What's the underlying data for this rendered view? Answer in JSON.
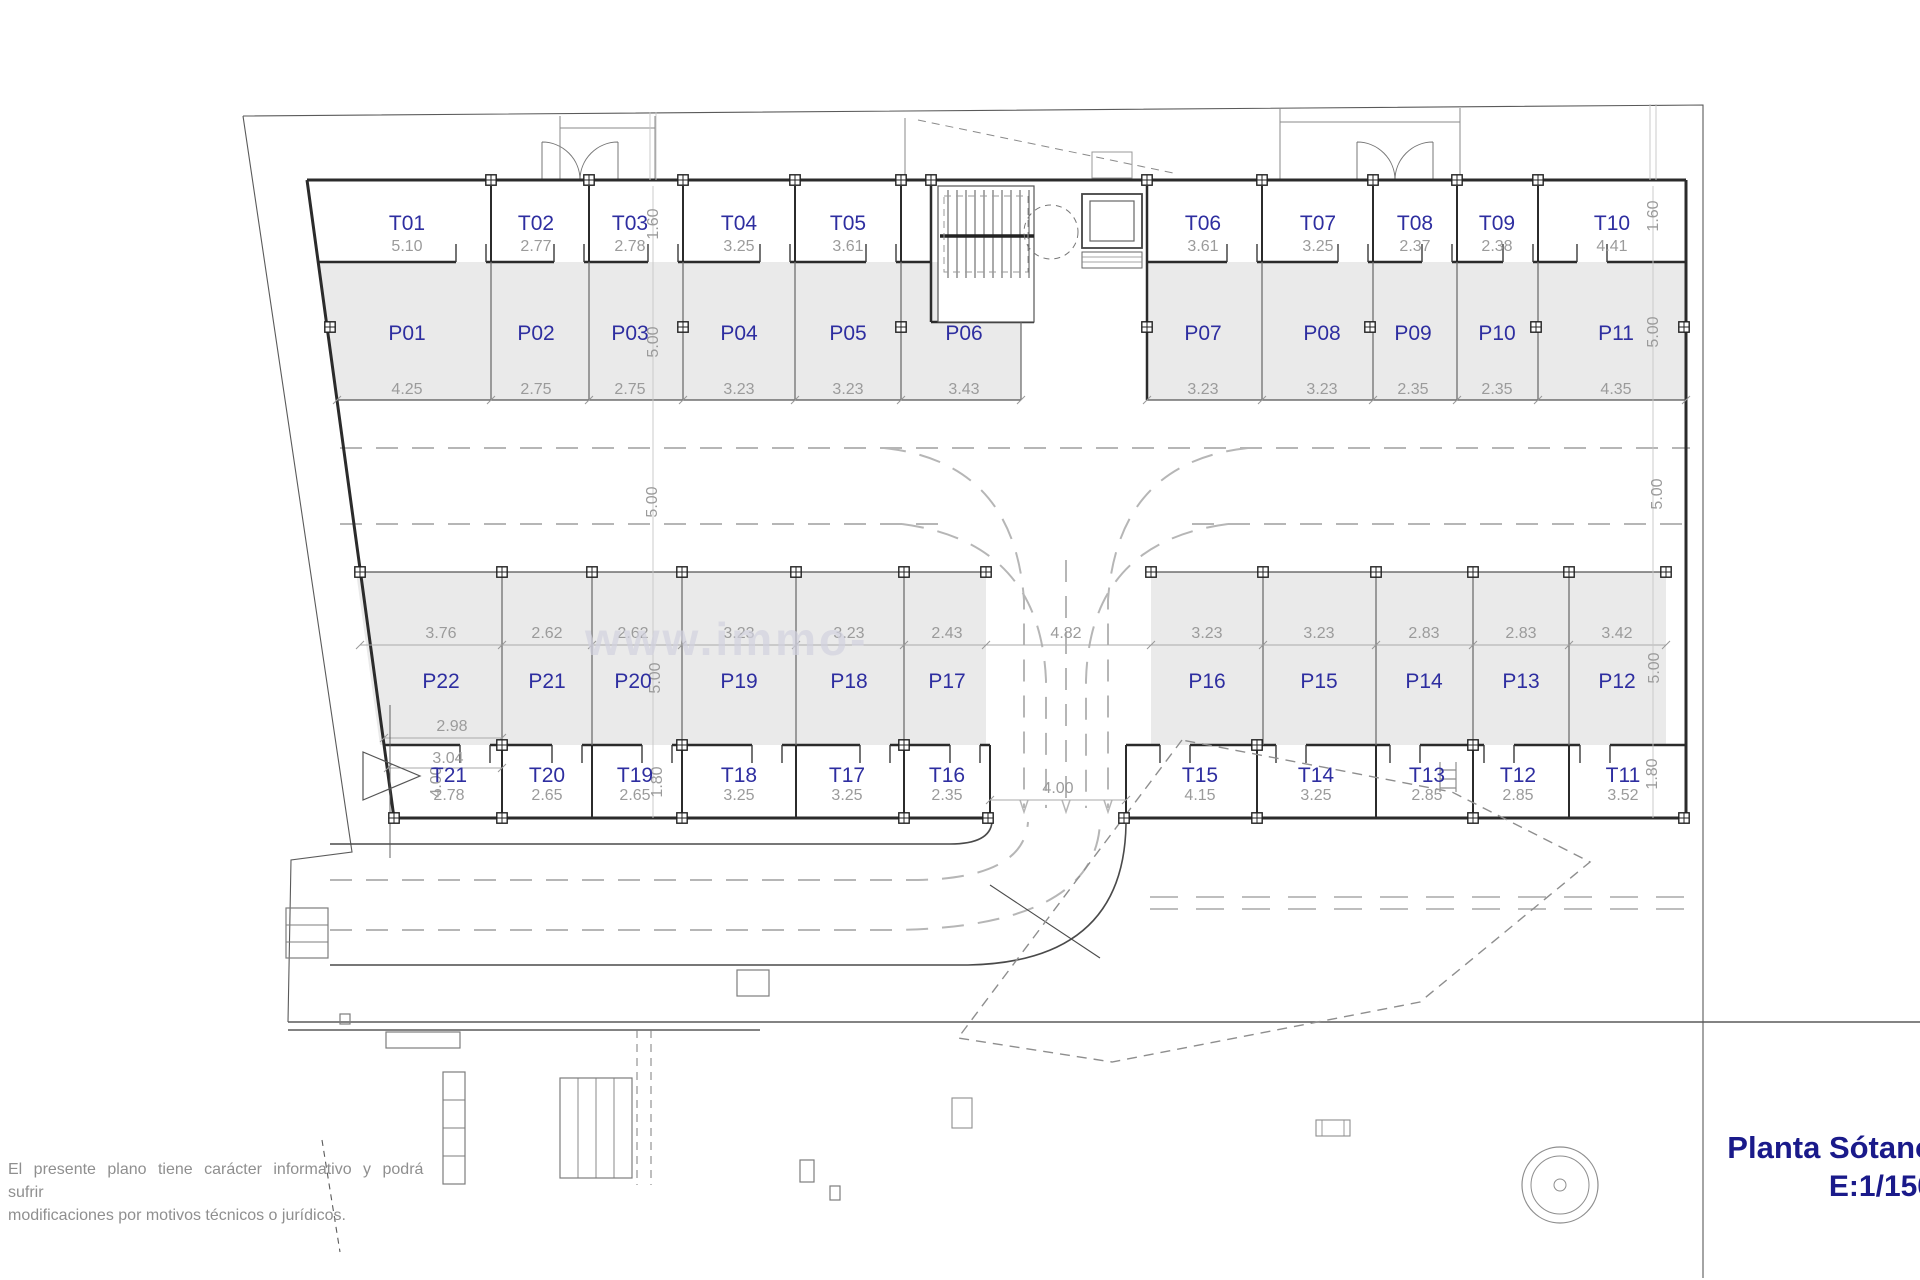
{
  "header": {
    "title": "Planta Sótano",
    "scale_label": "E:1/150"
  },
  "footer": {
    "disclaimer_line1": "El presente plano tiene carácter informativo y podrá sufrir",
    "disclaimer_line2": "modificaciones por motivos técnicos o jurídicos."
  },
  "watermark": "www.immo-",
  "colors": {
    "unit_label": "#2e2ea0",
    "dimension": "#9b9b9b",
    "stall_fill": "#eaeaea",
    "wall": "#2b2b2b",
    "title": "#1a1a8a"
  },
  "plan": {
    "top_trasteros": [
      {
        "id": "T01",
        "width": "5.10"
      },
      {
        "id": "T02",
        "width": "2.77"
      },
      {
        "id": "T03",
        "width": "2.78"
      },
      {
        "id": "T04",
        "width": "3.25"
      },
      {
        "id": "T05",
        "width": "3.61"
      },
      {
        "id": "T06",
        "width": "3.61"
      },
      {
        "id": "T07",
        "width": "3.25"
      },
      {
        "id": "T08",
        "width": "2.37"
      },
      {
        "id": "T09",
        "width": "2.38"
      },
      {
        "id": "T10",
        "width": "4.41"
      }
    ],
    "top_parkings": [
      {
        "id": "P01",
        "width": "4.25"
      },
      {
        "id": "P02",
        "width": "2.75"
      },
      {
        "id": "P03",
        "width": "2.75"
      },
      {
        "id": "P04",
        "width": "3.23"
      },
      {
        "id": "P05",
        "width": "3.23"
      },
      {
        "id": "P06",
        "width": "3.43"
      },
      {
        "id": "P07",
        "width": "3.23"
      },
      {
        "id": "P08",
        "width": "3.23"
      },
      {
        "id": "P09",
        "width": "2.35"
      },
      {
        "id": "P10",
        "width": "2.35"
      },
      {
        "id": "P11",
        "width": "4.35"
      }
    ],
    "bottom_parkings": [
      {
        "id": "P22",
        "width": "3.76"
      },
      {
        "id": "P21",
        "width": "2.62"
      },
      {
        "id": "P20",
        "width": "2.62"
      },
      {
        "id": "P19",
        "width": "3.23"
      },
      {
        "id": "P18",
        "width": "3.23"
      },
      {
        "id": "P17",
        "width": "2.43"
      },
      {
        "id": "P16",
        "width": "3.23"
      },
      {
        "id": "P15",
        "width": "3.23"
      },
      {
        "id": "P14",
        "width": "2.83"
      },
      {
        "id": "P13",
        "width": "2.83"
      },
      {
        "id": "P12",
        "width": "3.42"
      }
    ],
    "bottom_trasteros": [
      {
        "id": "T21",
        "width": "2.78"
      },
      {
        "id": "T20",
        "width": "2.65"
      },
      {
        "id": "T19",
        "width": "2.65"
      },
      {
        "id": "T18",
        "width": "3.25"
      },
      {
        "id": "T17",
        "width": "3.25"
      },
      {
        "id": "T16",
        "width": "2.35"
      },
      {
        "id": "T15",
        "width": "4.15"
      },
      {
        "id": "T14",
        "width": "3.25"
      },
      {
        "id": "T13",
        "width": "2.85"
      },
      {
        "id": "T12",
        "width": "2.85"
      },
      {
        "id": "T11",
        "width": "3.52"
      }
    ],
    "depths": {
      "trastero_top": "1.60",
      "stall": "5.00",
      "lane": "5.00",
      "trastero_bottom": "1.80"
    },
    "center_span": "4.82",
    "ramp_width": "4.00",
    "west_ramp_width": "4.00",
    "p22_front": "2.98",
    "p22_access": "3.04"
  }
}
